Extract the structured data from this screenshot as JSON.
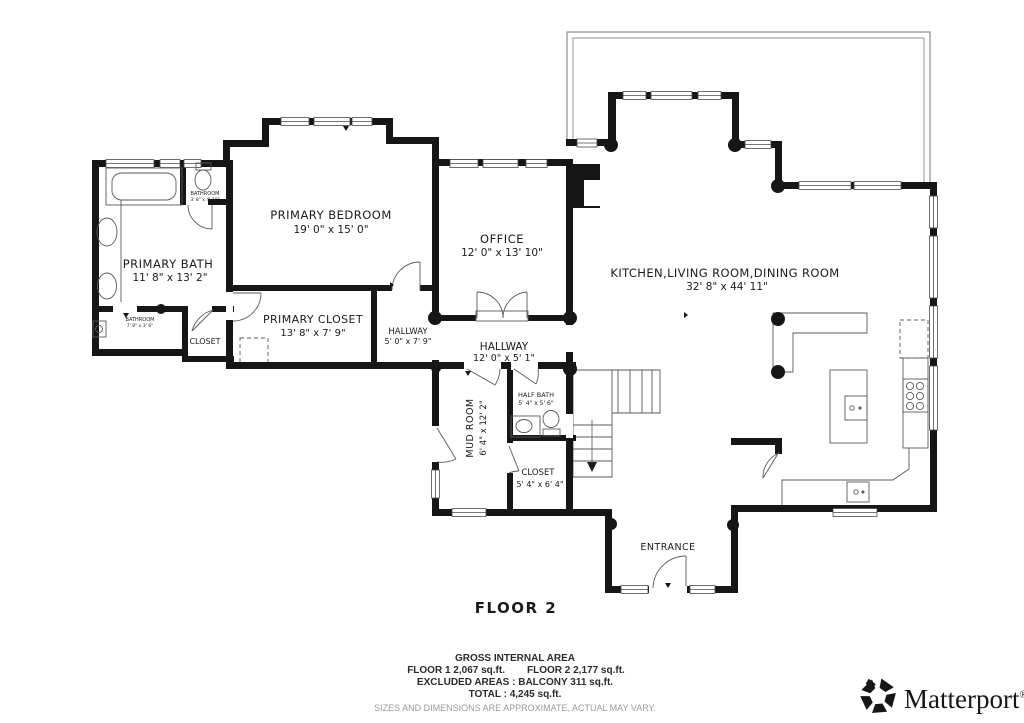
{
  "floor_plan": {
    "floor_label": "FLOOR 2",
    "rooms": [
      {
        "id": "primary-bedroom",
        "name": "PRIMARY BEDROOM",
        "dims": "19' 0\" x 15' 0\""
      },
      {
        "id": "office",
        "name": "OFFICE",
        "dims": "12' 0\" x 13' 10\""
      },
      {
        "id": "primary-bath",
        "name": "PRIMARY BATH",
        "dims": "11' 8\" x 13' 2\""
      },
      {
        "id": "bathroom-upper",
        "name": "BATHROOM",
        "dims": "3' 8\" x 4' 10\""
      },
      {
        "id": "bathroom-lower",
        "name": "BATHROOM",
        "dims": "7' 8\" x 3' 6\""
      },
      {
        "id": "closet-bath",
        "name": "CLOSET",
        "dims": ""
      },
      {
        "id": "primary-closet",
        "name": "PRIMARY CLOSET",
        "dims": "13' 8\" x 7' 9\""
      },
      {
        "id": "hallway-small",
        "name": "HALLWAY",
        "dims": "5' 0\" x 7' 9\""
      },
      {
        "id": "hallway-main",
        "name": "HALLWAY",
        "dims": "12' 0\" x 5' 1\""
      },
      {
        "id": "kitchen-living-dining",
        "name": "KITCHEN,LIVING ROOM,DINING ROOM",
        "dims": "32' 8\" x 44' 11\""
      },
      {
        "id": "mud-room",
        "name": "MUD ROOM",
        "dims": "6' 4\" x 12' 2\""
      },
      {
        "id": "half-bath",
        "name": "HALF BATH",
        "dims": "5' 4\" x 5' 6\""
      },
      {
        "id": "closet-entry",
        "name": "CLOSET",
        "dims": "5' 4\" x 6' 4\""
      },
      {
        "id": "entrance",
        "name": "ENTRANCE",
        "dims": ""
      }
    ]
  },
  "footer": {
    "title": "GROSS INTERNAL AREA",
    "floor1": "FLOOR 1 2,067 sq.ft.",
    "floor2": "FLOOR 2 2,177 sq.ft.",
    "excluded": "EXCLUDED AREAS :  BALCONY 311 sq.ft.",
    "total": "TOTAL :  4,245 sq.ft.",
    "disclaimer": "SIZES AND DIMENSIONS ARE APPROXIMATE, ACTUAL MAY VARY."
  },
  "brand": {
    "name": "Matterport",
    "registered": "®"
  },
  "colors": {
    "wall": "#161616",
    "line": "#4a4a4a",
    "text": "#1b1b1b",
    "muted": "#9a9a9a"
  }
}
